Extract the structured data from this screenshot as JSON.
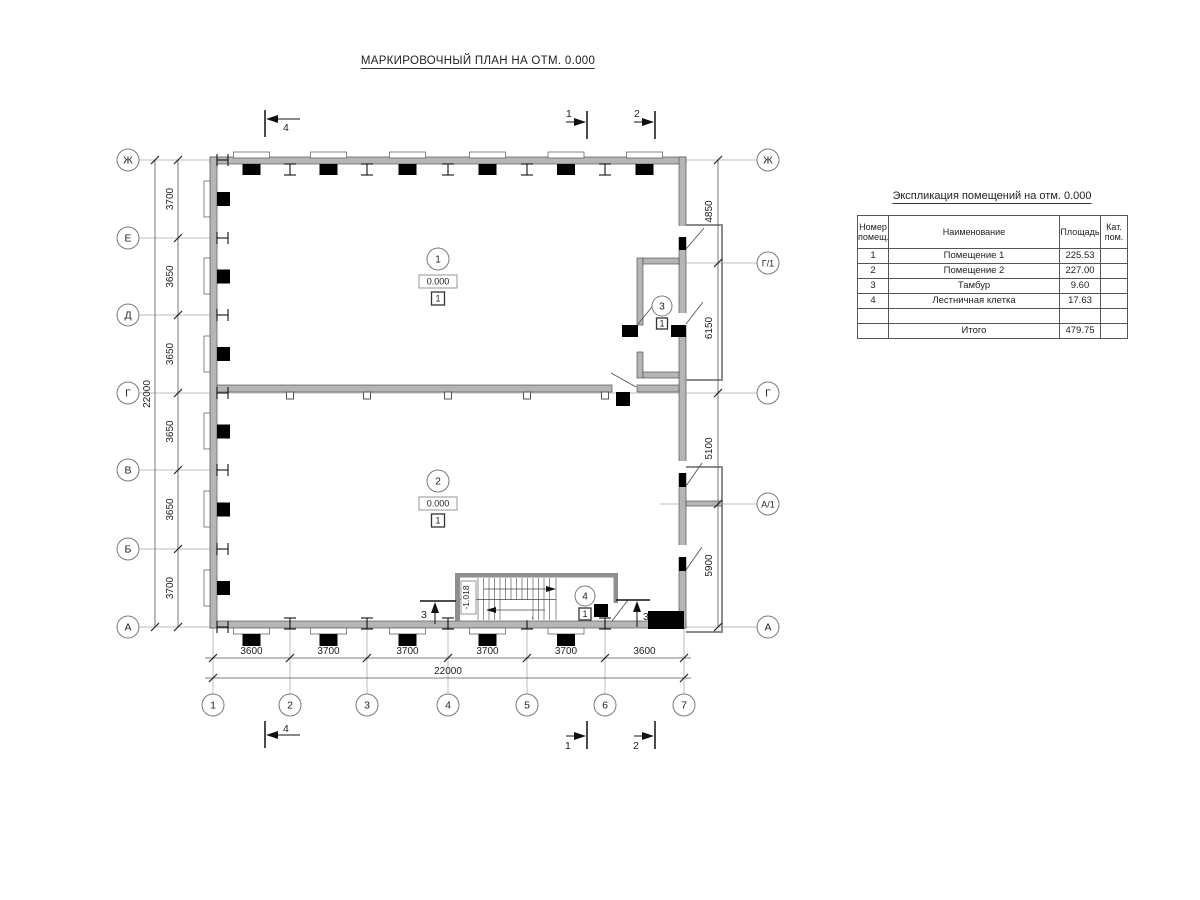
{
  "title": "МАРКИРОВОЧНЫЙ ПЛАН НА ОТМ. 0.000",
  "axes": {
    "left": [
      "Ж",
      "Е",
      "Д",
      "Г",
      "В",
      "Б",
      "А"
    ],
    "right": [
      "Ж",
      "Г/1",
      "Г",
      "А/1",
      "А"
    ],
    "bottom": [
      "1",
      "2",
      "3",
      "4",
      "5",
      "6",
      "7"
    ]
  },
  "dims": {
    "left": [
      "3700",
      "3650",
      "3650",
      "3650",
      "3650",
      "3700"
    ],
    "left_total": "22000",
    "right": [
      "4850",
      "6150",
      "5100",
      "5900"
    ],
    "bottom": [
      "3600",
      "3700",
      "3700",
      "3700",
      "3700",
      "3600"
    ],
    "bottom_total": "22000"
  },
  "sections": {
    "one": "1",
    "two": "2",
    "three": "3",
    "four": "4"
  },
  "rooms": {
    "r1": {
      "number": "1",
      "elevation": "0.000",
      "floor": "1"
    },
    "r2": {
      "number": "2",
      "elevation": "0.000",
      "floor": "1"
    },
    "r3": {
      "number": "3",
      "floor": "1"
    },
    "r4": {
      "number": "4",
      "floor": "1"
    }
  },
  "stair": {
    "landing_elevation": "-1.018"
  },
  "table": {
    "title": "Экспликация помещений на отм. 0.000",
    "headers": {
      "num": "Номер помещ.",
      "name": "Наименование",
      "area": "Площадь",
      "cat": "Кат. пом."
    },
    "rows": [
      {
        "num": "1",
        "name": "Помещение 1",
        "area": "225.53"
      },
      {
        "num": "2",
        "name": "Помещение 2",
        "area": "227.00"
      },
      {
        "num": "3",
        "name": "Тамбур",
        "area": "9.60"
      },
      {
        "num": "4",
        "name": "Лестничная клетка",
        "area": "17.63"
      }
    ],
    "total_label": "Итого",
    "total_value": "479.75"
  }
}
